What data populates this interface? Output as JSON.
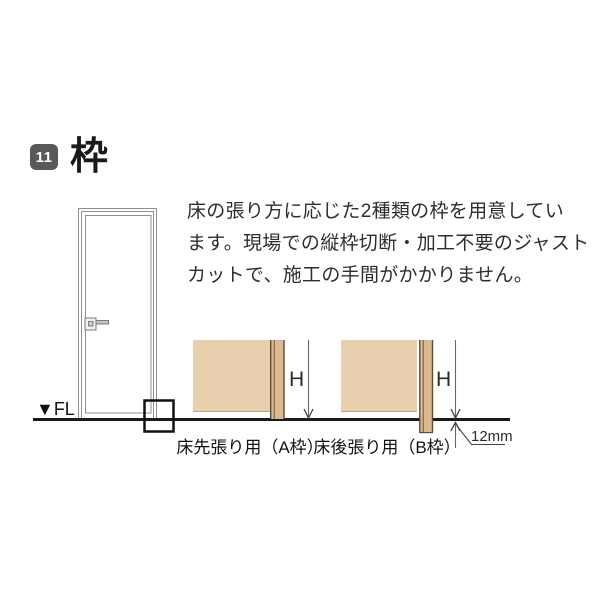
{
  "header": {
    "number": "11",
    "title": "枠",
    "badge_color": "#58595b"
  },
  "intro": {
    "lines": [
      "床の張り方に応じた2種類の枠を用意してい",
      "ます。現場での縦枠切断・加工不要のジャスト",
      "カットで、施工の手間がかかりません。"
    ]
  },
  "diagram": {
    "floor_label": "▼FL",
    "section_a": {
      "caption": "床先張り用（A枠）",
      "height_label": "H"
    },
    "section_b": {
      "caption": "床後張り用（B枠）",
      "height_label": "H",
      "offset_label": "12mm"
    },
    "colors": {
      "wall_fill": "#e8cfae",
      "frame_fill": "#dcba90",
      "frame_edge": "#5f4b36",
      "wall_bottom_edge": "#c4a377",
      "drawing_line": "#8f8f8f",
      "dimension_line": "#666666",
      "floor_line": "#1a1a1a"
    }
  }
}
